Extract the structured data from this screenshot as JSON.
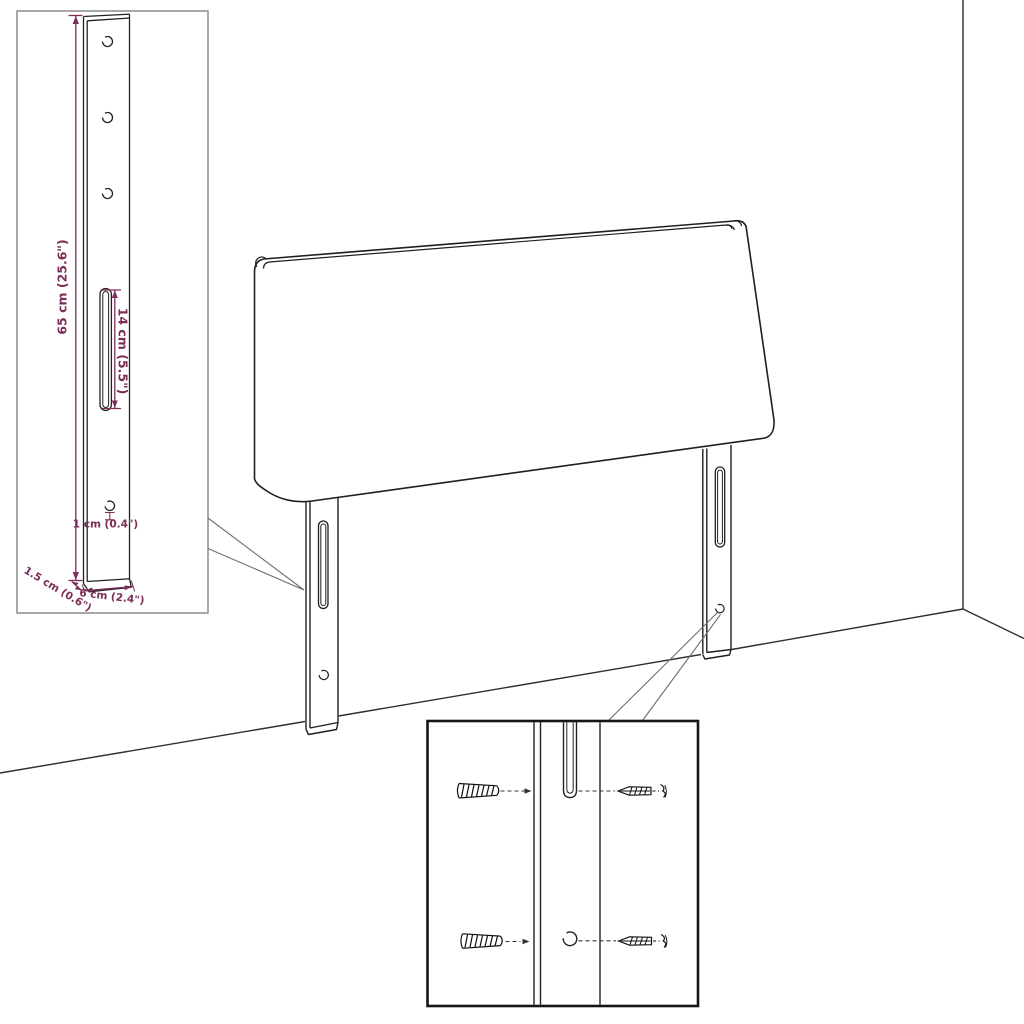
{
  "colors": {
    "background": "#ffffff",
    "outline": "#1f1f1f",
    "dimension": "#7c2d58",
    "callout": "#6f6f6f",
    "inset_border_light": "#8c8c8c",
    "inset_border_dark": "#151515"
  },
  "leg_detail_inset": {
    "dimensions": {
      "leg_height": "65 cm (25.6\")",
      "slot_length": "14 cm (5.5\")",
      "hole_diameter": "1 cm (0.4\")",
      "leg_depth": "1.5 cm (0.6\")",
      "leg_width": "6 cm (2.4\")"
    },
    "top_hole_count": 3
  },
  "mount_detail_inset": {
    "rows": 2,
    "hardware_icons": [
      "wall-plug-icon",
      "screw-icon"
    ]
  }
}
